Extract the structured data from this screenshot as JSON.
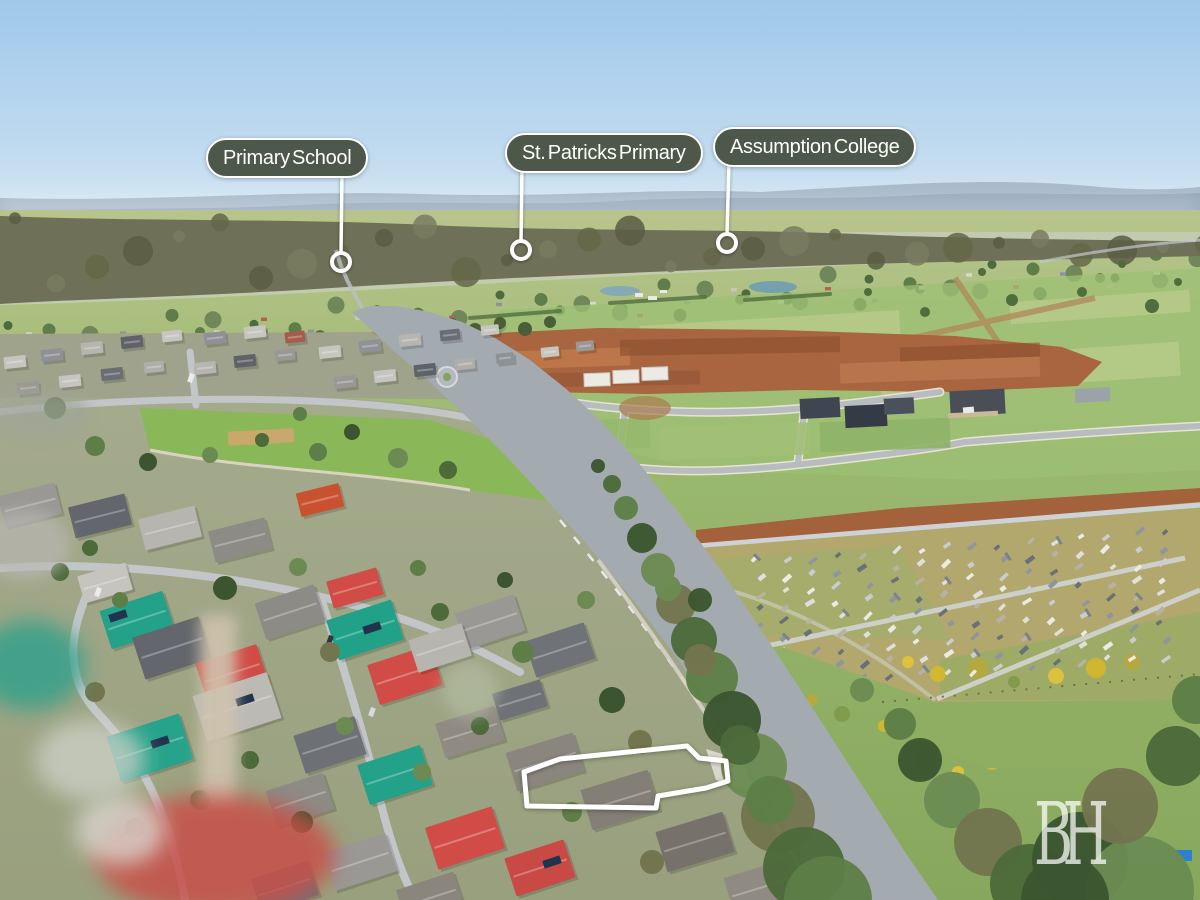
{
  "annotations": {
    "labels": [
      {
        "id": "primary-school",
        "text": "Primary School"
      },
      {
        "id": "st-patricks-primary",
        "text": "St. Patricks Primary"
      },
      {
        "id": "assumption-college",
        "text": "Assumption College"
      }
    ]
  },
  "watermark": {
    "monogram": "BH"
  },
  "highlight": {
    "type": "property-boundary-outline"
  },
  "colors": {
    "label_pill_bg": "#4d584a",
    "label_pill_border": "#ffffff",
    "label_text": "#ffffff",
    "leader_line": "#ffffff",
    "boundary_outline": "#ffffff",
    "sky_top": "#9fc8ea",
    "sky_horizon": "#d3e5f2"
  }
}
